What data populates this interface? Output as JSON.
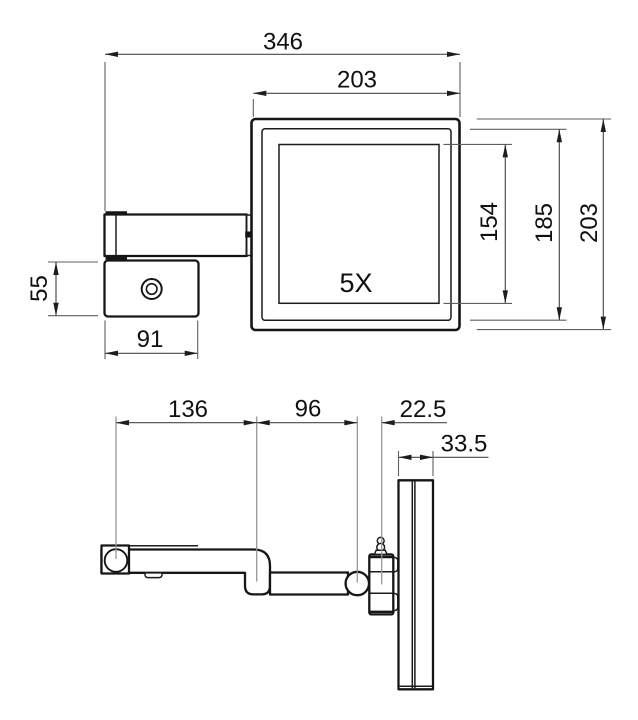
{
  "drawing": {
    "title": "wall-mounted magnifying mirror dimension drawing",
    "background_color": "#ffffff",
    "line_color": "#161616",
    "dimension_line_color": "#4a4a4a",
    "magnification_label": "5X",
    "front_view": {
      "dims": {
        "overall_width": "346",
        "mirror_width": "203",
        "glass_height": "154",
        "frame_height": "185",
        "mirror_height": "203",
        "bracket_height": "55",
        "bracket_width": "91"
      }
    },
    "side_view": {
      "dims": {
        "arm_first_segment": "136",
        "arm_second_segment": "96",
        "pivot_offset": "22.5",
        "panel_depth": "33.5"
      }
    }
  }
}
